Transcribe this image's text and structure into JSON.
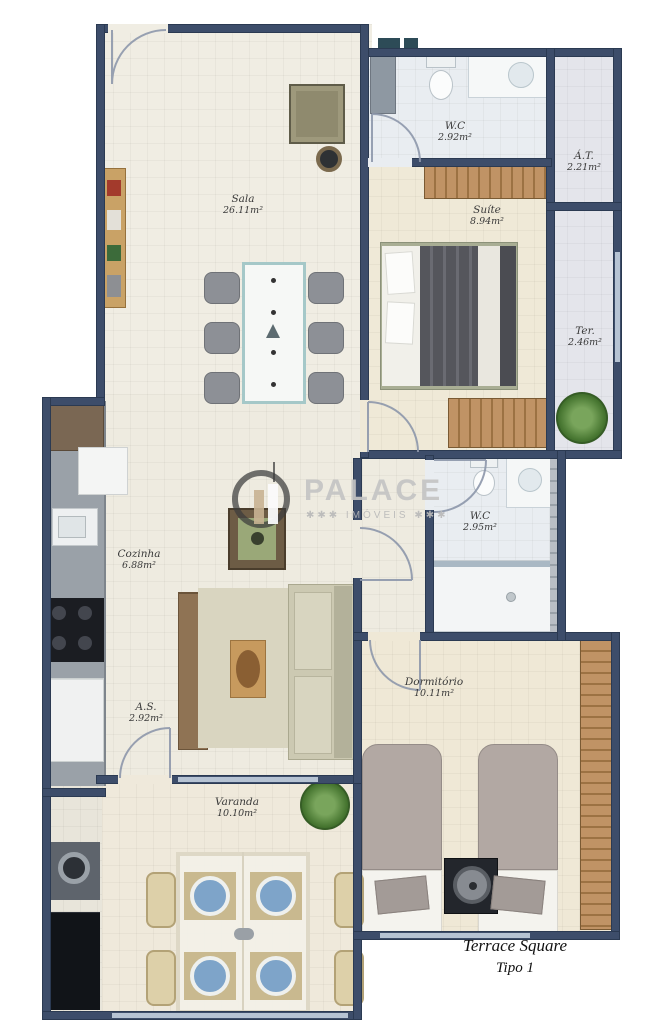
{
  "title": {
    "line1": "Terrace Square",
    "line2": "Tipo 1"
  },
  "watermark": {
    "brand": "PALACE",
    "sub": "✱✱✱ IMÓVEIS ✱✱✱"
  },
  "rooms": {
    "sala": {
      "name": "Sala",
      "area": "26.11m²"
    },
    "wc1": {
      "name": "W.C",
      "area": "2.92m²"
    },
    "suite": {
      "name": "Suíte",
      "area": "8.94m²"
    },
    "at": {
      "name": "Á.T.",
      "area": "2.21m²"
    },
    "ter": {
      "name": "Ter.",
      "area": "2.46m²"
    },
    "cozinha": {
      "name": "Cozinha",
      "area": "6.88m²"
    },
    "wc2": {
      "name": "W.C",
      "area": "2.95m²"
    },
    "dormitorio": {
      "name": "Dormitório",
      "area": "10.11m²"
    },
    "as": {
      "name": "A.S.",
      "area": "2.92m²"
    },
    "varanda": {
      "name": "Varanda",
      "area": "10.10m²"
    }
  },
  "colors": {
    "wall": "#3d4d6a",
    "floor_living": "#f0ede3",
    "floor_bath": "#e9edf1",
    "floor_terrace": "#e4e5eb",
    "accent_table": "#a5c8c8",
    "wardrobe": "#c09365"
  }
}
